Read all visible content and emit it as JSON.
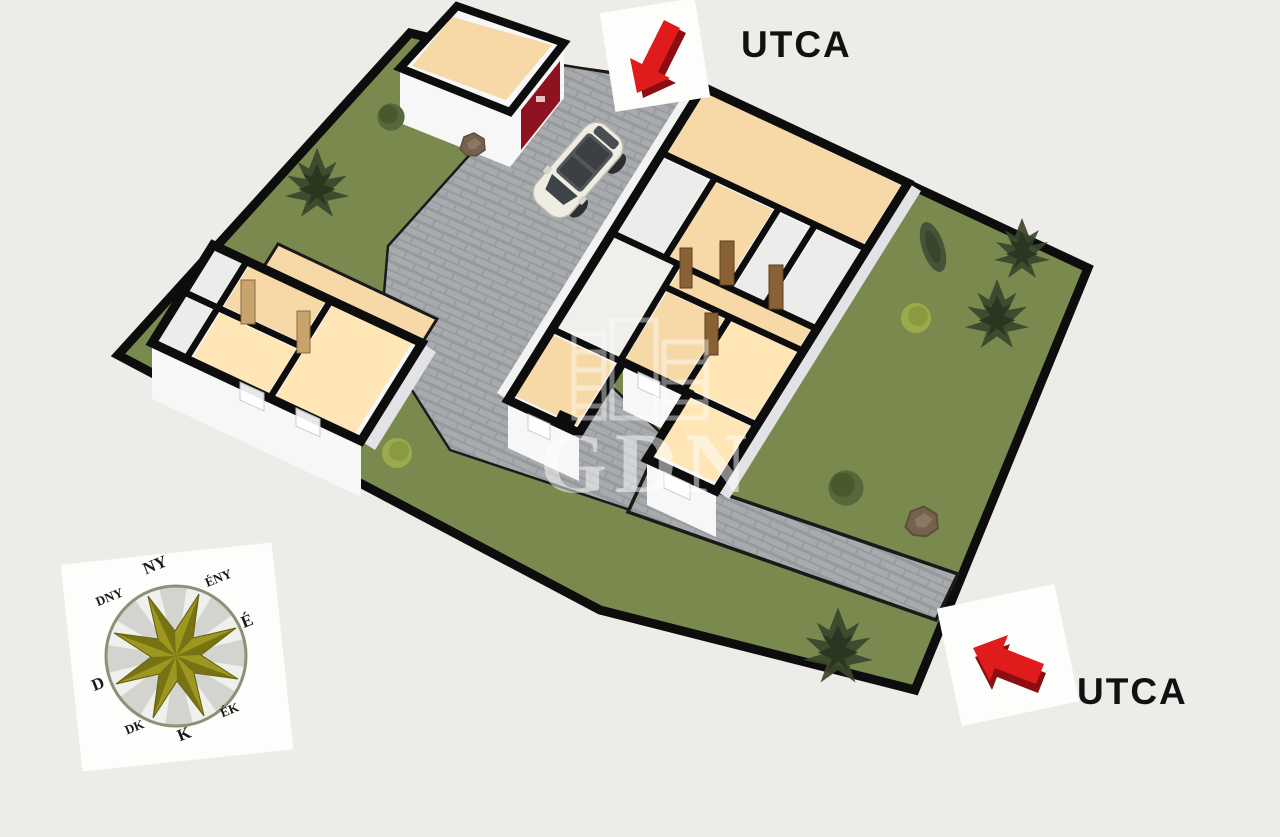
{
  "scene": {
    "background": "#EDECE8",
    "type": "3d-floorplan-site"
  },
  "labels": {
    "street_top": "UTCA",
    "street_bottom": "UTCA"
  },
  "watermark": {
    "text": "GDN"
  },
  "compass": {
    "north": "É",
    "northeast": "ÉK",
    "east": "K",
    "southeast": "DK",
    "south": "D",
    "southwest": "DNY",
    "west": "NY",
    "northwest": "ÉNY"
  },
  "colors": {
    "sceneBg": "#EDECE8",
    "grass": "#7A8A4F",
    "paver": "#A8ABAD",
    "paverJoint": "#94979B",
    "floorTan": "#F6D9A7",
    "floorLit": "#FFE6B6",
    "floorGray": "#ECECEA",
    "wall": "#F7F7F7",
    "wallShade": "#E3E3E7",
    "outline": "#0D0D0D",
    "garageDoor": "#8F1220",
    "arrow": "#DF1B1B",
    "arrowDark": "#8C0E12",
    "star": "#9C981F",
    "starDark": "#6E6A10",
    "card": "#FDFDFC",
    "text": "#111111",
    "doorWood": "#8A6134",
    "doorLight": "#C8A36B"
  }
}
